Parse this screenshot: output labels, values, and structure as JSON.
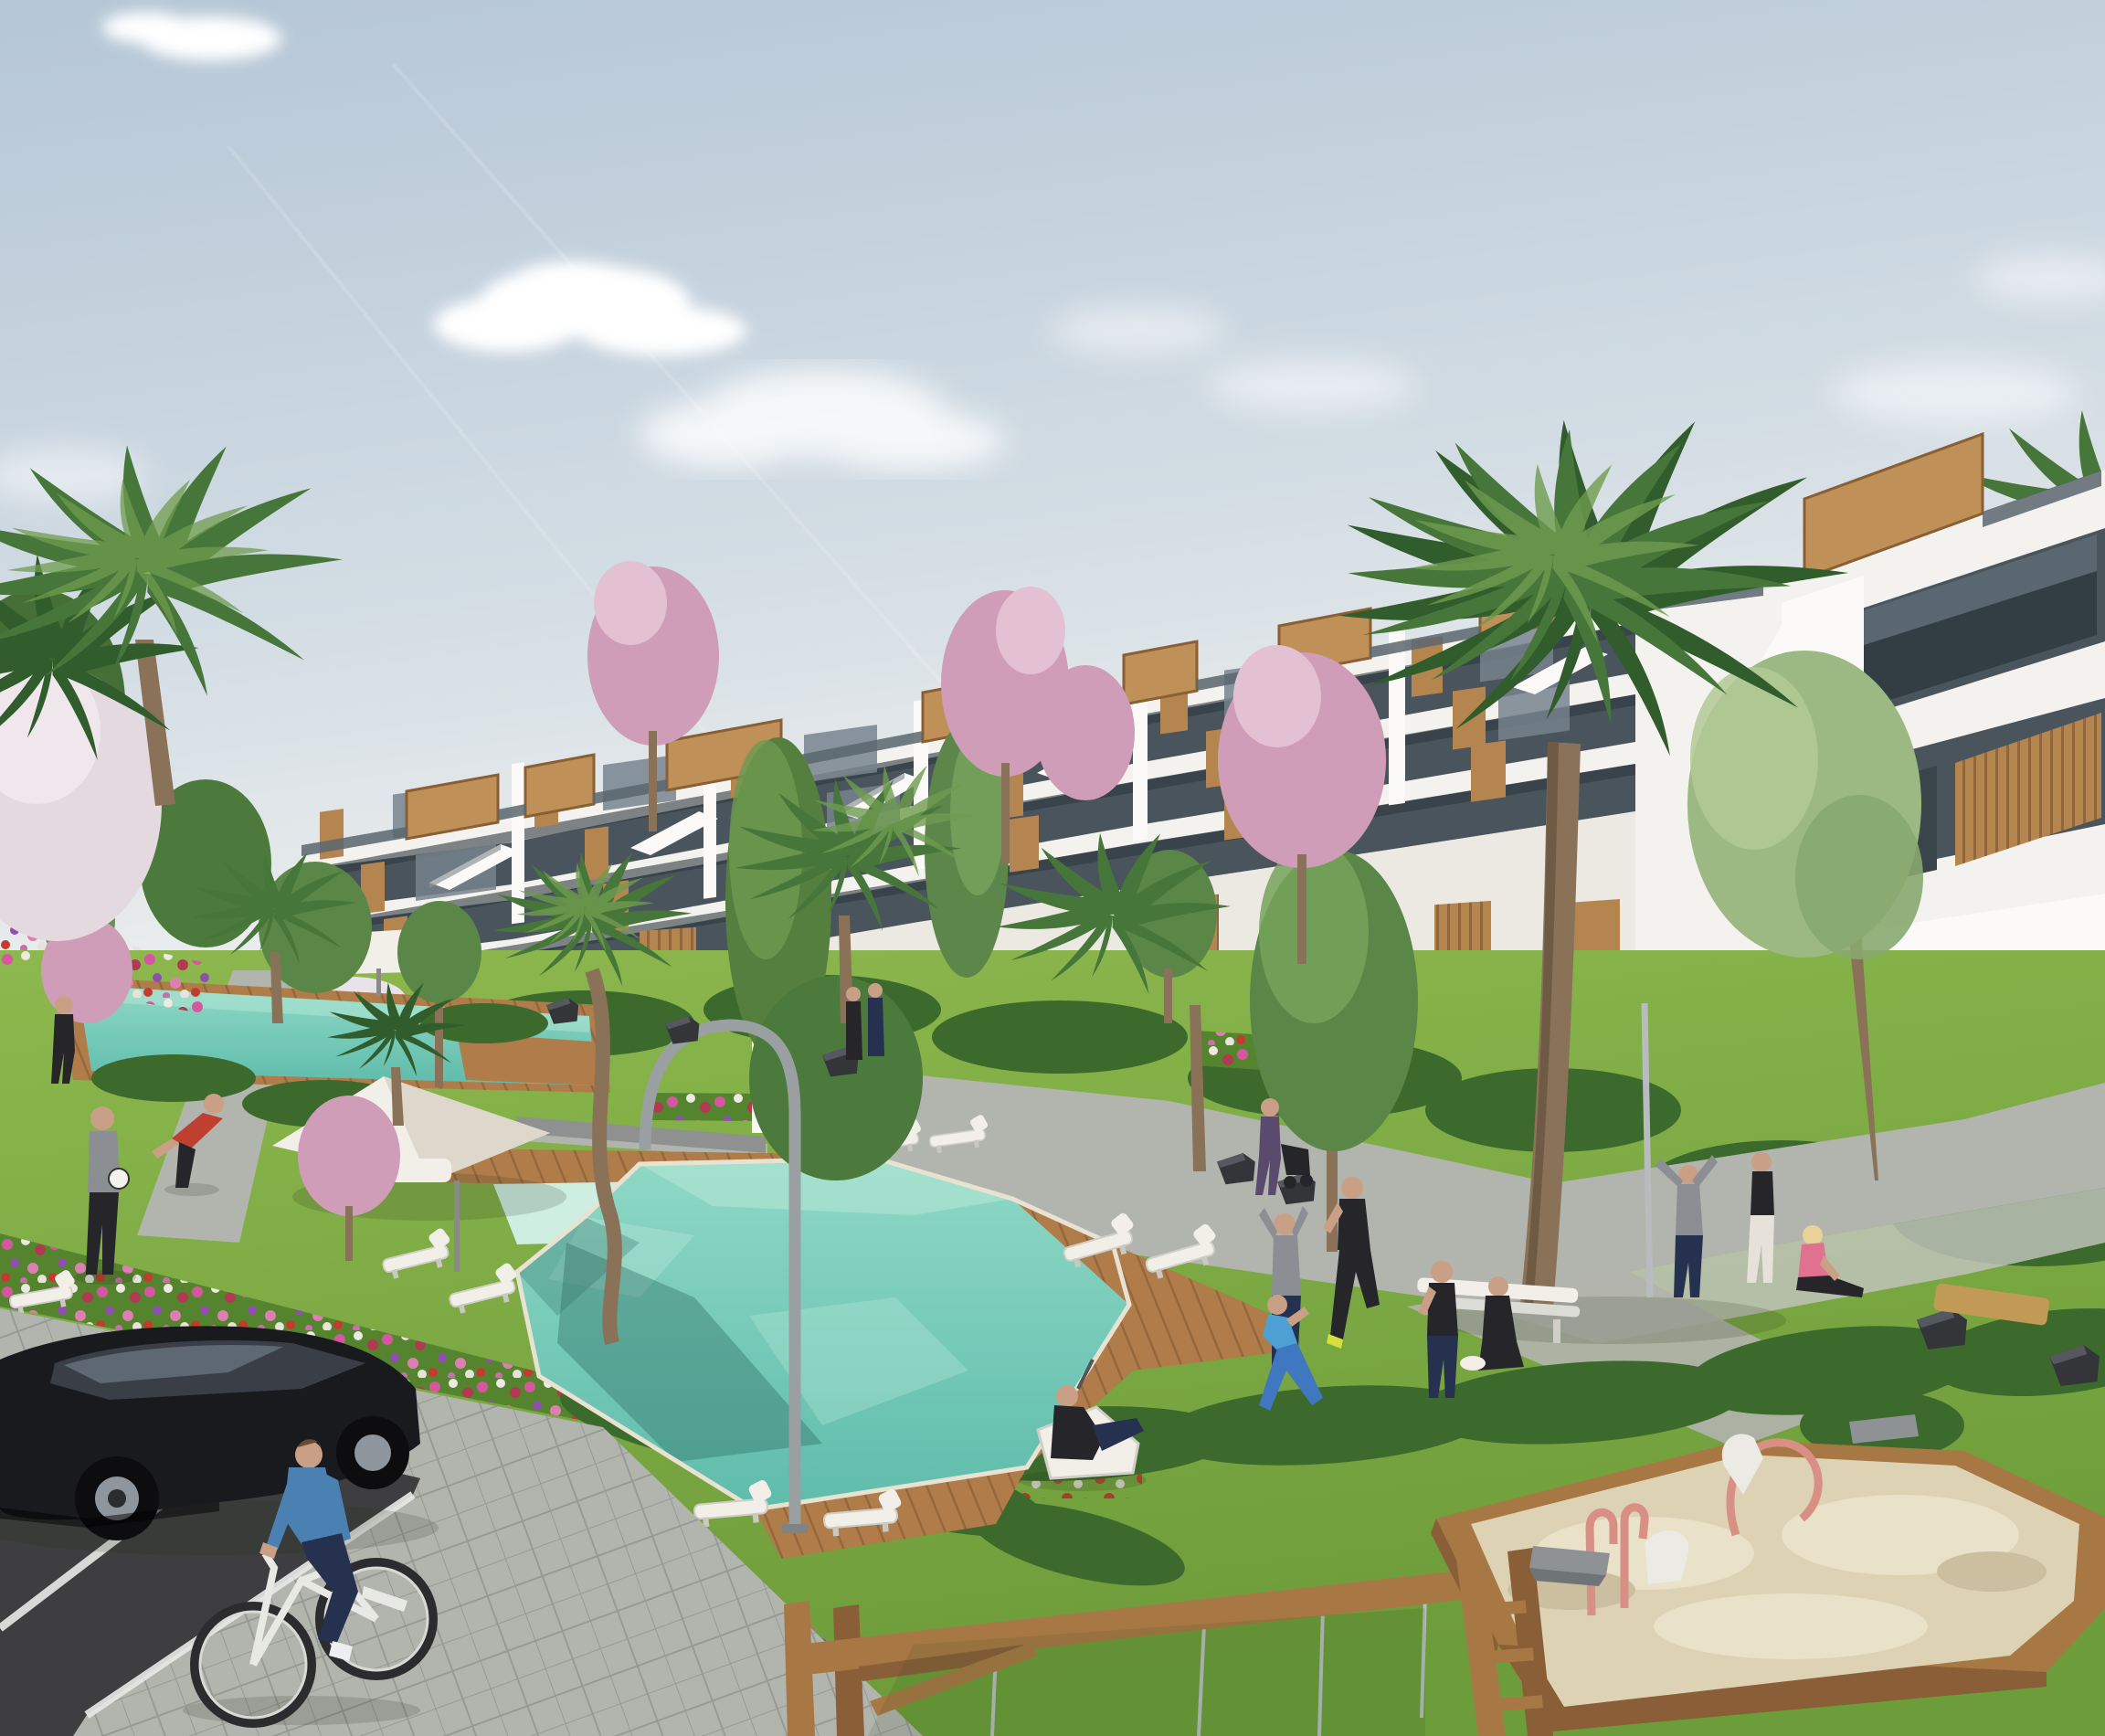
{
  "scene": {
    "kind": "photorealistic-architectural-render",
    "subject": "modern white terraced apartment complex with landscaped gardens, pools, playground and parking",
    "time_of_day": "sunny daytime",
    "camera": "elevated three-quarter aerial view"
  },
  "palette": {
    "sky_top": "#b5c6d6",
    "sky_low": "#e9ecec",
    "cloud": "#ffffff",
    "facade": "#f3f2ee",
    "band": "#fbfaf8",
    "glass": "#49545c",
    "glass_light": "#76848e",
    "wood": "#b5854f",
    "wood_dark": "#8a5f33",
    "roofwood": "#bf9058",
    "terra": "#c08848",
    "terra_dark": "#9a6a33",
    "grass": "#7aa83f",
    "grass_light": "#94bd55",
    "grass_dark": "#55842f",
    "hedge": "#3c6a2c",
    "palm": "#47763a",
    "palm_dark": "#315c2b",
    "palm_light": "#6e9c4e",
    "blossom": "#cf9db8",
    "blossom_light": "#e3c1d2",
    "pool": "#6ec6b4",
    "pool_light": "#b6e7d6",
    "pool_pale": "#cdeee0",
    "deck": "#b07c49",
    "deck_dark": "#8e6136",
    "path": "#b2b4ae",
    "path_light": "#c4c6c0",
    "asphalt": "#3e3e40",
    "line_white": "#e9e9e7",
    "car": "#191a1e",
    "metal": "#9aa0a2",
    "white_fabric": "#f2efe8",
    "bench_dark": "#343539",
    "sand": "#ddd3b4",
    "sand_light": "#e9e1c8",
    "sand_wood": "#a87844",
    "trunk": "#8a7258",
    "skin": "#c9a086",
    "blue_cloth": "#4a80b2",
    "navy_cloth": "#25314f",
    "red_cloth": "#bf3f31",
    "pink_cloth": "#e0718f",
    "black_cloth": "#26262a",
    "gray_cloth": "#8b8e93"
  },
  "sky": {
    "clouds": 6,
    "contrails": 2
  },
  "building": {
    "style": "stacked stepped volumes, white parapet bands",
    "floors_visible": 4,
    "features": [
      "rooftop wooden pergola boxes",
      "glass balustrades",
      "dark glazing",
      "vertical timber slat panels",
      "external stair parapets",
      "ground-floor arches with terracotta walls"
    ]
  },
  "pools": [
    {
      "id": "main-pool",
      "shape": "angled rectangle with stepped edges",
      "water": "turquoise",
      "surround": "timber deck"
    },
    {
      "id": "kids-pool",
      "shape": "small square",
      "water": "pale green"
    },
    {
      "id": "back-pool",
      "shape": "long lap pool",
      "water": "turquoise"
    }
  ],
  "vegetation": {
    "palms": 9,
    "pink_blossom_trees": 6,
    "green_trees": 7,
    "hedges": "clipped rows",
    "flower_beds": [
      "pink",
      "magenta",
      "red",
      "white",
      "purple"
    ]
  },
  "people": [
    {
      "id": "cyclist",
      "action": "riding bike on pavement",
      "clothing": [
        "blue long-sleeve",
        "navy trousers",
        "white shoes"
      ]
    },
    {
      "id": "ball-player-grey",
      "action": "holding football"
    },
    {
      "id": "ball-player-red",
      "action": "reaching for ball"
    },
    {
      "id": "walker-left-edge",
      "action": "walking near back pool"
    },
    {
      "id": "pram-walker",
      "action": "pushing pram on path"
    },
    {
      "id": "recliner",
      "action": "lounging on deck chair by pool"
    },
    {
      "id": "stretcher-arms-up",
      "action": "stretching arms raised"
    },
    {
      "id": "lunge-woman",
      "action": "exercising in blue sportswear"
    },
    {
      "id": "runner-black",
      "action": "jogging in black sportswear"
    },
    {
      "id": "standing-boy",
      "action": "standing on lawn"
    },
    {
      "id": "kneeling-woman",
      "action": "kneeling on lawn"
    },
    {
      "id": "pole-stretcher",
      "action": "stretching by post"
    },
    {
      "id": "standing-woman",
      "action": "standing on path"
    },
    {
      "id": "sitting-pink-woman",
      "action": "sitting on path"
    },
    {
      "id": "distant-couple",
      "action": "walking near back pool"
    }
  ],
  "street": {
    "parking": {
      "surface": "dark asphalt",
      "markings": "white bay lines"
    },
    "vehicle": {
      "id": "black-hatchback",
      "color": "black",
      "wheels": "alloy rims"
    },
    "pavement": "grey concrete pavers"
  },
  "playground": {
    "swing_frame": "timber posts and beam with four chains",
    "sandbox": {
      "border": "timber",
      "fill": "sand",
      "toys": [
        "copper pipe riders",
        "grey digger seats",
        "white swan rider"
      ]
    }
  },
  "furniture": {
    "sun_loungers_white": 11,
    "parasols_white": 2,
    "benches_dark": 8,
    "bench_timber": 1,
    "arch_lamp": 1,
    "flag_pole": 1
  }
}
